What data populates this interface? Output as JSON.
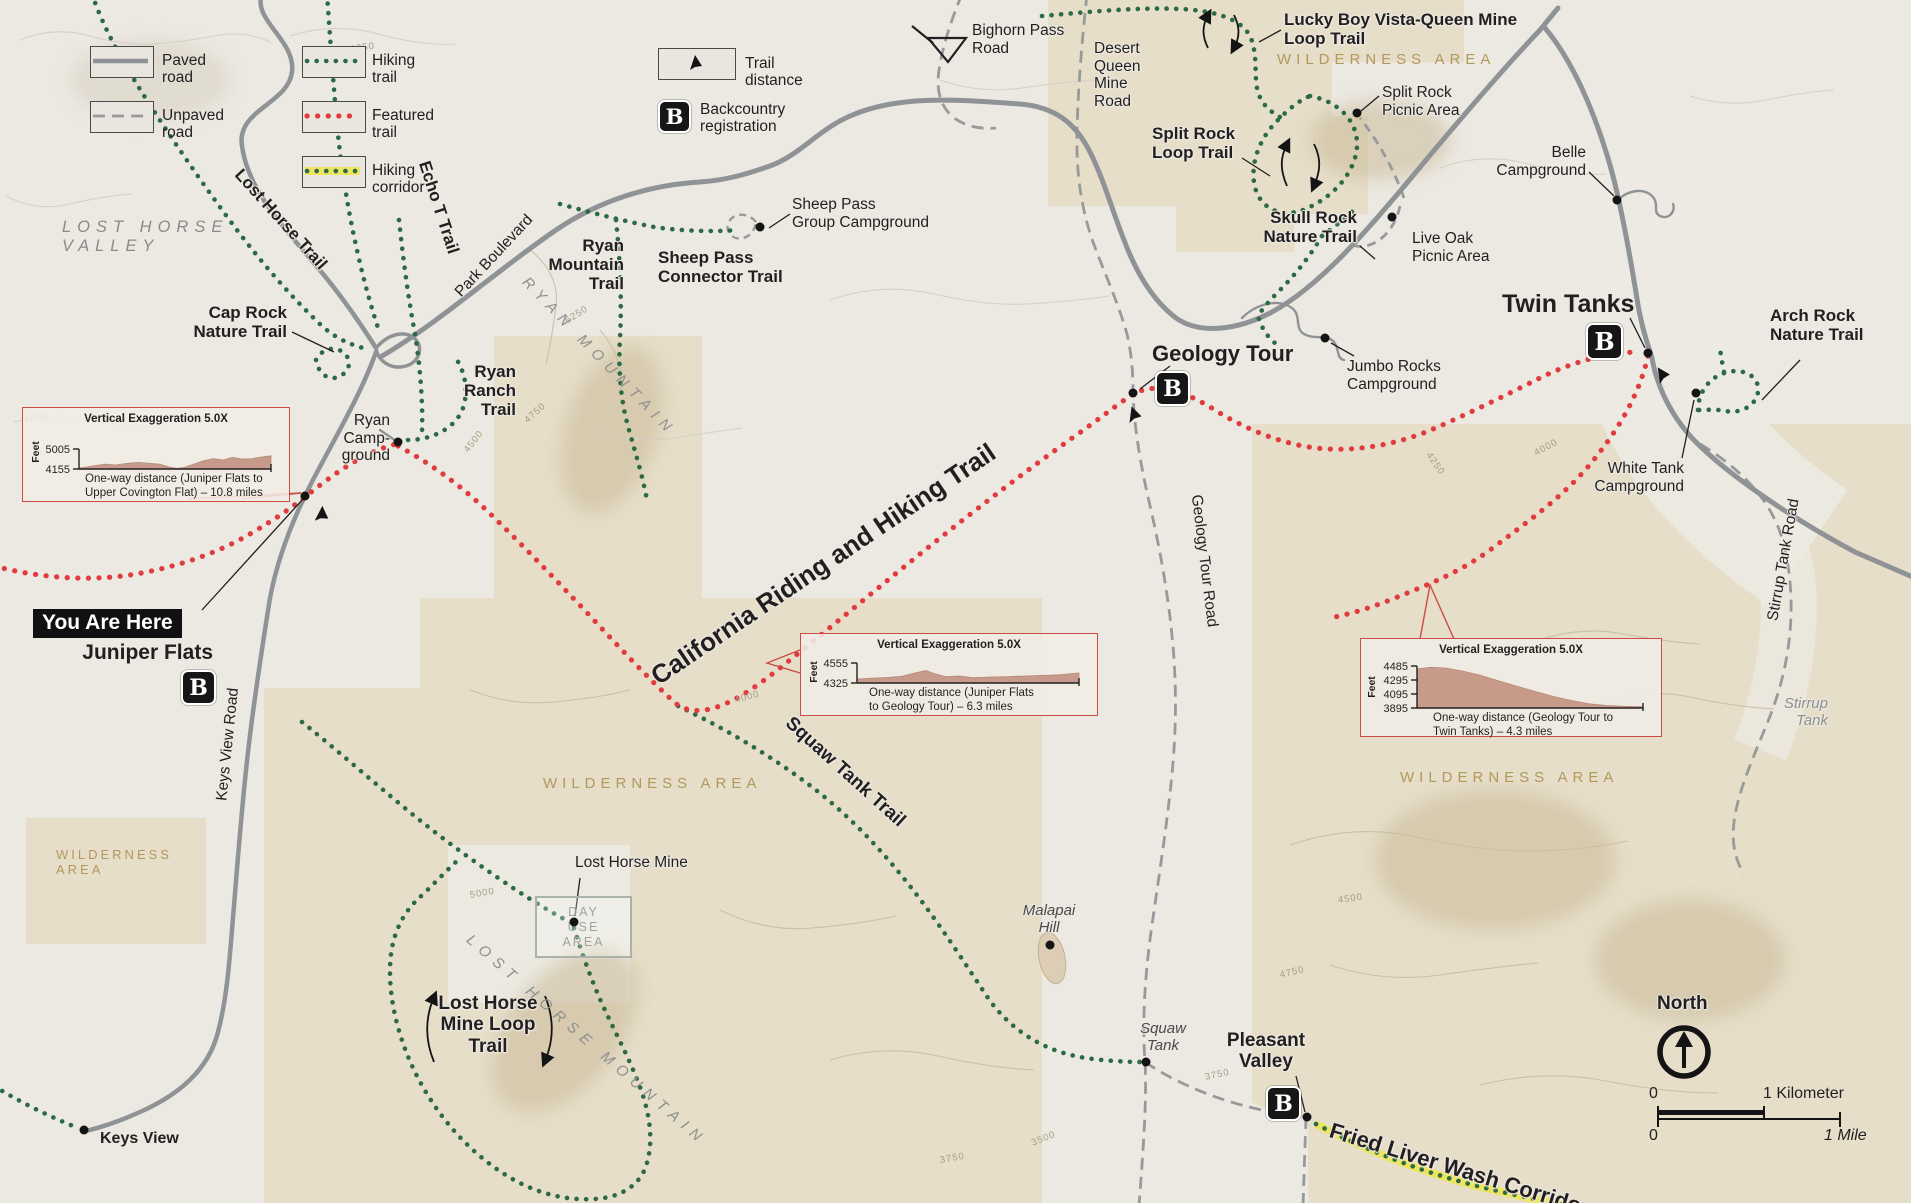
{
  "colors": {
    "paper": "#ECE9E2",
    "wilderness_tan": "#E6DEC9",
    "paved_road": "#8F9396",
    "hiking_trail_green": "#2B6A45",
    "featured_trail_red": "#E13B3E",
    "corridor_yellow": "#EDE45F",
    "wilderness_label": "#B3985C",
    "profile_border": "#CC4B44",
    "profile_fill": "#C29080",
    "label_black": "#231F20"
  },
  "b_glyph": "B",
  "legend": {
    "items": [
      {
        "name": "paved-road",
        "label": "Paved road"
      },
      {
        "name": "unpaved-road",
        "label": "Unpaved road"
      },
      {
        "name": "hiking-trail",
        "label": "Hiking trail"
      },
      {
        "name": "featured-trail",
        "label": "Featured trail"
      },
      {
        "name": "hiking-corridor",
        "label": "Hiking corridor"
      },
      {
        "name": "trail-distance",
        "label": "Trail distance"
      },
      {
        "name": "backcountry-registration",
        "label": "Backcountry\nregistration"
      }
    ]
  },
  "profiles": [
    {
      "title": "Vertical Exaggeration 5.0X",
      "unit": "Feet",
      "ticks": [
        "5005",
        "4155"
      ],
      "caption1": "One-way distance (Juniper Flats to",
      "caption2": "Upper Covington Flat) – 10.8  miles",
      "shape": [
        [
          0,
          0.05
        ],
        [
          0.04,
          0.1
        ],
        [
          0.09,
          0.18
        ],
        [
          0.14,
          0.24
        ],
        [
          0.19,
          0.2
        ],
        [
          0.25,
          0.28
        ],
        [
          0.31,
          0.33
        ],
        [
          0.37,
          0.28
        ],
        [
          0.42,
          0.24
        ],
        [
          0.47,
          0.1
        ],
        [
          0.51,
          0.03
        ],
        [
          0.55,
          0.08
        ],
        [
          0.6,
          0.25
        ],
        [
          0.65,
          0.42
        ],
        [
          0.7,
          0.52
        ],
        [
          0.75,
          0.45
        ],
        [
          0.8,
          0.58
        ],
        [
          0.85,
          0.5
        ],
        [
          0.9,
          0.52
        ],
        [
          0.95,
          0.6
        ],
        [
          1,
          0.66
        ]
      ]
    },
    {
      "title": "Vertical Exaggeration 5.0X",
      "unit": "Feet",
      "ticks": [
        "4555",
        "4325"
      ],
      "caption1": "One-way distance (Juniper Flats",
      "caption2": "to Geology Tour) – 6.3  miles",
      "shape": [
        [
          0,
          0.2
        ],
        [
          0.07,
          0.24
        ],
        [
          0.14,
          0.28
        ],
        [
          0.2,
          0.33
        ],
        [
          0.26,
          0.5
        ],
        [
          0.31,
          0.62
        ],
        [
          0.35,
          0.46
        ],
        [
          0.4,
          0.32
        ],
        [
          0.46,
          0.35
        ],
        [
          0.52,
          0.27
        ],
        [
          0.6,
          0.3
        ],
        [
          0.68,
          0.32
        ],
        [
          0.76,
          0.35
        ],
        [
          0.84,
          0.38
        ],
        [
          0.92,
          0.42
        ],
        [
          1,
          0.5
        ]
      ]
    },
    {
      "title": "Vertical Exaggeration 5.0X",
      "unit": "Feet",
      "ticks": [
        "4485",
        "4295",
        "4095",
        "3895"
      ],
      "caption1": "One-way distance (Geology Tour to",
      "caption2": "Twin Tanks) – 4.3  miles",
      "shape": [
        [
          0,
          0.93
        ],
        [
          0.06,
          0.97
        ],
        [
          0.13,
          0.95
        ],
        [
          0.2,
          0.88
        ],
        [
          0.28,
          0.78
        ],
        [
          0.36,
          0.65
        ],
        [
          0.44,
          0.52
        ],
        [
          0.52,
          0.4
        ],
        [
          0.6,
          0.28
        ],
        [
          0.68,
          0.18
        ],
        [
          0.76,
          0.1
        ],
        [
          0.84,
          0.06
        ],
        [
          0.92,
          0.04
        ],
        [
          1,
          0.03
        ]
      ]
    }
  ],
  "you_are_here": {
    "banner": "You Are Here",
    "place": "Juniper Flats"
  },
  "scale": {
    "north": "North",
    "zero_km": "0",
    "one_km": "1 Kilometer",
    "zero_mi": "0",
    "one_mi": "1 Mile"
  },
  "labels": [
    {
      "n": "lost-horse-valley",
      "t": "LOST HORSE\nVALLEY",
      "x": 62,
      "y": 218,
      "cls": "valley"
    },
    {
      "n": "lost-horse-trail",
      "t": "Lost Horse Trail",
      "x": 238,
      "y": 162,
      "cls": "b17",
      "rot": 48
    },
    {
      "n": "echo-t-trail",
      "t": "Echo T Trail",
      "x": 424,
      "y": 152,
      "cls": "b17",
      "rot": 72
    },
    {
      "n": "park-boulevard",
      "t": "Park Boulevard",
      "x": 458,
      "y": 286,
      "cls": "reg",
      "rot": -47
    },
    {
      "n": "ryan-mountain-trail",
      "t": "Ryan\nMountain\nTrail",
      "x": 624,
      "y": 236,
      "cls": "b17 ta-r",
      "anchor": "end"
    },
    {
      "n": "cap-rock-nature-trail",
      "t": "Cap Rock\nNature Trail",
      "x": 287,
      "y": 303,
      "cls": "b17 ta-r",
      "anchor": "end"
    },
    {
      "n": "ryan-ranch-trail",
      "t": "Ryan\nRanch\nTrail",
      "x": 516,
      "y": 362,
      "cls": "b17 ta-r",
      "anchor": "end"
    },
    {
      "n": "ryan-campground",
      "t": "Ryan\nCamp-\nground",
      "x": 390,
      "y": 412,
      "cls": "reg ta-r",
      "anchor": "end"
    },
    {
      "n": "sheep-pass-connector-trail",
      "t": "Sheep Pass\nConnector Trail",
      "x": 658,
      "y": 248,
      "cls": "b17"
    },
    {
      "n": "sheep-pass-group-campground",
      "t": "Sheep Pass\nGroup Campground",
      "x": 792,
      "y": 196,
      "cls": "reg"
    },
    {
      "n": "bighorn-pass-road",
      "t": "Bighorn Pass\nRoad",
      "x": 972,
      "y": 22,
      "cls": "reg"
    },
    {
      "n": "desert-queen-mine-road",
      "t": "Desert\nQueen\nMine\nRoad",
      "x": 1094,
      "y": 40,
      "cls": "reg"
    },
    {
      "n": "lucky-boy-vista-queen-mine-loop-trail",
      "t": "Lucky Boy Vista-Queen Mine\nLoop Trail",
      "x": 1284,
      "y": 10,
      "cls": "b17"
    },
    {
      "n": "wilderness-area-ne",
      "t": "WILDERNESS AREA",
      "x": 1277,
      "y": 52,
      "cls": "wild"
    },
    {
      "n": "split-rock-loop-trail",
      "t": "Split Rock\nLoop Trail",
      "x": 1152,
      "y": 124,
      "cls": "b17"
    },
    {
      "n": "split-rock-picnic-area",
      "t": "Split Rock\nPicnic Area",
      "x": 1382,
      "y": 84,
      "cls": "reg"
    },
    {
      "n": "skull-rock-nature-trail",
      "t": "Skull Rock\nNature Trail",
      "x": 1357,
      "y": 208,
      "cls": "b17 ta-r",
      "anchor": "end"
    },
    {
      "n": "live-oak-picnic-area",
      "t": "Live Oak\nPicnic Area",
      "x": 1412,
      "y": 230,
      "cls": "reg"
    },
    {
      "n": "belle-campground",
      "t": "Belle\nCampground",
      "x": 1586,
      "y": 144,
      "cls": "reg ta-r",
      "anchor": "end"
    },
    {
      "n": "twin-tanks",
      "t": "Twin Tanks",
      "x": 1502,
      "y": 290,
      "cls": "b25"
    },
    {
      "n": "arch-rock-nature-trail",
      "t": "Arch Rock\nNature Trail",
      "x": 1770,
      "y": 306,
      "cls": "b17"
    },
    {
      "n": "white-tank-campground",
      "t": "White Tank\nCampground",
      "x": 1684,
      "y": 460,
      "cls": "reg ta-r",
      "anchor": "end"
    },
    {
      "n": "stirrup-tank-road",
      "t": "Stirrup Tank Road",
      "x": 1773,
      "y": 612,
      "cls": "reg",
      "rot": -80
    },
    {
      "n": "stirrup-tank",
      "t": "Stirrup\nTank",
      "x": 1828,
      "y": 696,
      "cls": "gray-it ta-r",
      "anchor": "end"
    },
    {
      "n": "jumbo-rocks-campground",
      "t": "Jumbo Rocks\nCampground",
      "x": 1347,
      "y": 358,
      "cls": "reg"
    },
    {
      "n": "geology-tour",
      "t": "Geology Tour",
      "x": 1152,
      "y": 342,
      "cls": "b22"
    },
    {
      "n": "geology-tour-road",
      "t": "Geology Tour Road",
      "x": 1196,
      "y": 486,
      "cls": "reg",
      "rot": 83
    },
    {
      "n": "california-riding-and-hiking-trail",
      "t": "California Riding and Hiking Trail",
      "x": 654,
      "y": 664,
      "cls": "b26",
      "rot": -34
    },
    {
      "n": "wilderness-area-center",
      "t": "WILDERNESS AREA",
      "x": 543,
      "y": 776,
      "cls": "wild"
    },
    {
      "n": "wilderness-area-east",
      "t": "WILDERNESS AREA",
      "x": 1400,
      "y": 770,
      "cls": "wild"
    },
    {
      "n": "wilderness-area-west",
      "t": "WILDERNESS\nAREA",
      "x": 56,
      "y": 848,
      "cls": "wild-sm"
    },
    {
      "n": "squaw-tank-trail",
      "t": "Squaw Tank Trail",
      "x": 788,
      "y": 710,
      "cls": "b20",
      "rot": 42
    },
    {
      "n": "lost-horse-mine",
      "t": "Lost Horse Mine",
      "x": 575,
      "y": 854,
      "cls": "reg"
    },
    {
      "n": "day-use-area",
      "t": "DAY\nUSE\nAREA",
      "x": 535,
      "y": 896,
      "cls": "day-box"
    },
    {
      "n": "lost-horse-mine-loop-trail",
      "t": "Lost Horse\nMine Loop\nTrail",
      "x": 488,
      "y": 993,
      "cls": "b20 ta-c",
      "anchor": "middle"
    },
    {
      "n": "lost-horse-mountain",
      "t": "LOST HORSE MOUNTAIN",
      "x": 468,
      "y": 930,
      "cls": "mtn",
      "rot": 41
    },
    {
      "n": "ryan-mountain",
      "t": "RYAN MOUNTAIN",
      "x": 524,
      "y": 272,
      "cls": "mtn",
      "rot": 46
    },
    {
      "n": "keys-view-road",
      "t": "Keys View Road",
      "x": 222,
      "y": 792,
      "cls": "reg",
      "rot": -84
    },
    {
      "n": "keys-view",
      "t": "Keys View",
      "x": 100,
      "y": 1130,
      "cls": "b16"
    },
    {
      "n": "malapai-hill",
      "t": "Malapai\nHill",
      "x": 1049,
      "y": 903,
      "cls": "dark-it",
      "anchor": "middle"
    },
    {
      "n": "squaw-tank",
      "t": "Squaw\nTank",
      "x": 1163,
      "y": 1021,
      "cls": "dark-it",
      "anchor": "middle"
    },
    {
      "n": "pleasant-valley",
      "t": "Pleasant\nValley",
      "x": 1266,
      "y": 1030,
      "cls": "b20 ta-c",
      "anchor": "middle"
    },
    {
      "n": "fried-liver-wash-corridor",
      "t": "Fried Liver Wash Corridor",
      "x": 1330,
      "y": 1118,
      "cls": "b22",
      "rot": 17
    }
  ],
  "contours": [
    {
      "t": "4250",
      "x": 350,
      "y": 44,
      "rot": -8
    },
    {
      "t": "4500",
      "x": 24,
      "y": 414,
      "rot": -4
    },
    {
      "t": "5000",
      "x": 470,
      "y": 890,
      "rot": -10
    },
    {
      "t": "4000",
      "x": 1535,
      "y": 448,
      "rot": -28
    },
    {
      "t": "4250",
      "x": 1428,
      "y": 448,
      "rot": 55
    },
    {
      "t": "3750",
      "x": 1205,
      "y": 1072,
      "rot": -12
    },
    {
      "t": "3500",
      "x": 1032,
      "y": 1138,
      "rot": -22
    },
    {
      "t": "4500",
      "x": 1338,
      "y": 895,
      "rot": -8
    },
    {
      "t": "4750",
      "x": 1280,
      "y": 970,
      "rot": -14
    },
    {
      "t": "6250",
      "x": 566,
      "y": 316,
      "rot": -32
    },
    {
      "t": "4750",
      "x": 526,
      "y": 416,
      "rot": -42
    },
    {
      "t": "4500",
      "x": 466,
      "y": 446,
      "rot": -52
    },
    {
      "t": "4000",
      "x": 735,
      "y": 695,
      "rot": -15
    },
    {
      "t": "3750",
      "x": 940,
      "y": 1155,
      "rot": -10
    }
  ],
  "pois": [
    {
      "n": "juniper-flats-trailhead",
      "x": 305,
      "y": 496
    },
    {
      "n": "ryan-campground",
      "x": 398,
      "y": 442
    },
    {
      "n": "sheep-pass-group-campground",
      "x": 760,
      "y": 227
    },
    {
      "n": "geology-tour-junction",
      "x": 1133,
      "y": 393
    },
    {
      "n": "jumbo-rocks-campground",
      "x": 1325,
      "y": 338
    },
    {
      "n": "split-rock-picnic-area",
      "x": 1357,
      "y": 113
    },
    {
      "n": "live-oak-picnic-area",
      "x": 1392,
      "y": 217
    },
    {
      "n": "belle-campground",
      "x": 1617,
      "y": 200
    },
    {
      "n": "twin-tanks-junction",
      "x": 1648,
      "y": 353
    },
    {
      "n": "white-tank-campground",
      "x": 1696,
      "y": 393
    },
    {
      "n": "lost-horse-mine",
      "x": 574,
      "y": 922
    },
    {
      "n": "keys-view",
      "x": 84,
      "y": 1130
    },
    {
      "n": "malapai-hill",
      "x": 1050,
      "y": 945
    },
    {
      "n": "squaw-tank",
      "x": 1146,
      "y": 1062
    },
    {
      "n": "pleasant-valley",
      "x": 1307,
      "y": 1117
    }
  ],
  "b_icons": [
    {
      "n": "juniper-flats",
      "x": 181,
      "y": 670,
      "s": 31
    },
    {
      "n": "geology-tour",
      "x": 1155,
      "y": 371,
      "s": 31
    },
    {
      "n": "twin-tanks",
      "x": 1586,
      "y": 323,
      "s": 33
    },
    {
      "n": "pleasant-valley",
      "x": 1266,
      "y": 1086,
      "s": 31
    }
  ],
  "distance_markers": [
    {
      "n": "juniper",
      "x": 316,
      "y": 506,
      "rot": 10
    },
    {
      "n": "geology",
      "x": 1128,
      "y": 406,
      "rot": -10
    },
    {
      "n": "twin-tanks",
      "x": 1656,
      "y": 366,
      "rot": -25
    }
  ]
}
